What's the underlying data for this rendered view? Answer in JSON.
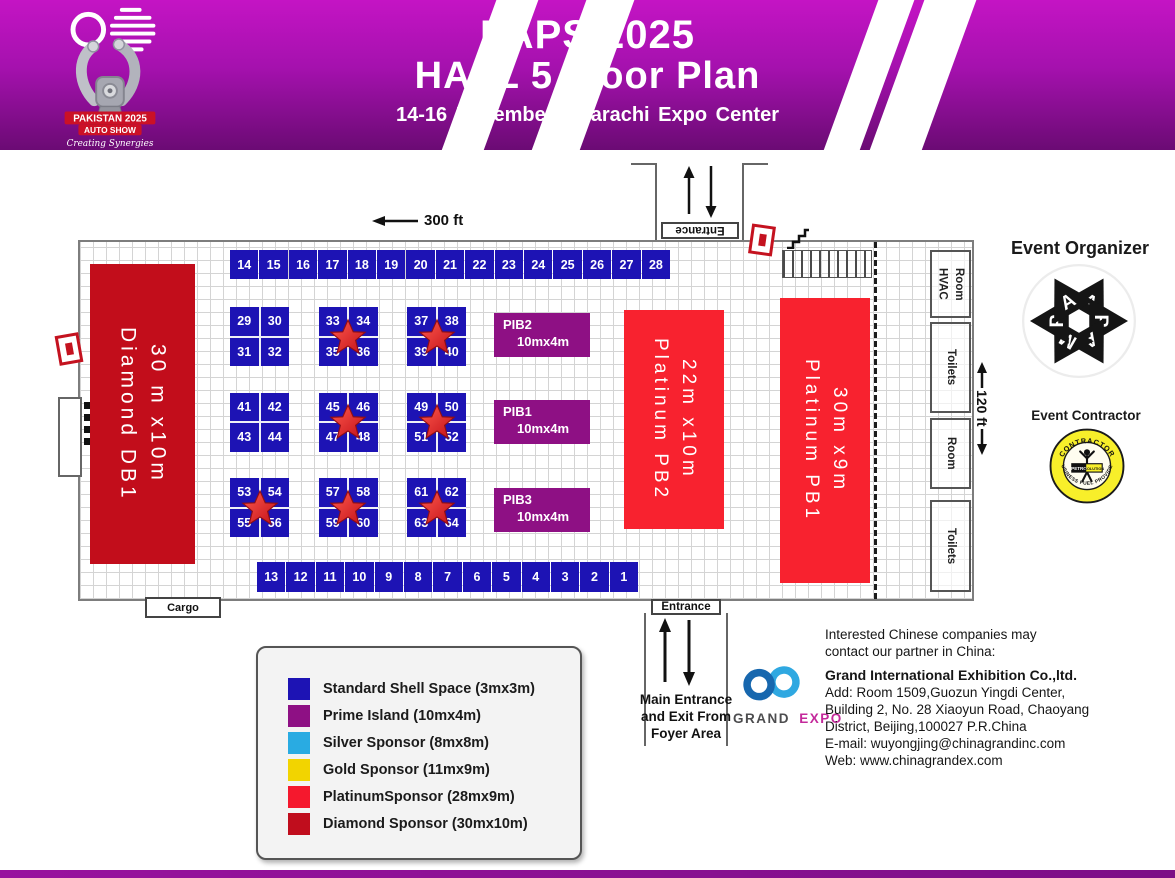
{
  "header": {
    "title_line1": "PAPS 2025",
    "title_line2": "HALL 5 Floor Plan",
    "subtitle": "14-16 November  |  Karachi Expo Center",
    "logo": {
      "name_line1": "PAKISTAN 2025",
      "name_line2": "AUTO SHOW",
      "tagline": "Creating Synergies"
    }
  },
  "floorplan": {
    "width_label": "300 ft",
    "height_label": "120 ft",
    "top_entrance_label": "Entrance",
    "bottom_entrance_label": "Entrance",
    "bottom_entrance_caption": "Main Entrance and Exit From Foyer Area",
    "cargo_label": "Cargo",
    "top_row_booths": [
      "14",
      "15",
      "16",
      "17",
      "18",
      "19",
      "20",
      "21",
      "22",
      "23",
      "24",
      "25",
      "26",
      "27",
      "28"
    ],
    "bottom_row_booths": [
      "13",
      "12",
      "11",
      "10",
      "9",
      "8",
      "7",
      "6",
      "5",
      "4",
      "3",
      "2",
      "1"
    ],
    "island_blocks": [
      {
        "booths": [
          "29",
          "30",
          "31",
          "32"
        ],
        "star": false
      },
      {
        "booths": [
          "33",
          "34",
          "35",
          "36"
        ],
        "star": true
      },
      {
        "booths": [
          "37",
          "38",
          "39",
          "40"
        ],
        "star": true
      },
      {
        "booths": [
          "41",
          "42",
          "43",
          "44"
        ],
        "star": false
      },
      {
        "booths": [
          "45",
          "46",
          "47",
          "48"
        ],
        "star": true
      },
      {
        "booths": [
          "49",
          "50",
          "51",
          "52"
        ],
        "star": true
      },
      {
        "booths": [
          "53",
          "54",
          "55",
          "56"
        ],
        "star": true
      },
      {
        "booths": [
          "57",
          "58",
          "59",
          "60"
        ],
        "star": true
      },
      {
        "booths": [
          "61",
          "62",
          "63",
          "64"
        ],
        "star": true
      }
    ],
    "prime_islands": [
      {
        "name": "PIB2",
        "size": "10mx4m"
      },
      {
        "name": "PIB1",
        "size": "10mx4m"
      },
      {
        "name": "PIB3",
        "size": "10mx4m"
      }
    ],
    "platinum_pb2": {
      "line1": "Platinum PB2",
      "line2": "22m x10m"
    },
    "platinum_pb1": {
      "line1": "Platinum PB1",
      "line2": "30m x9m"
    },
    "diamond_db1": {
      "line1": "Diamond DB1",
      "line2": "30 m x10m"
    },
    "rooms": [
      "HVAC\nRoom",
      "Toilets",
      "Room",
      "Toilets"
    ]
  },
  "legend": {
    "items": [
      {
        "label": "Standard Shell Space (3mx3m)",
        "color": "#1d13b4"
      },
      {
        "label": "Prime Island (10mx4m)",
        "color": "#8e1084"
      },
      {
        "label": "Silver Sponsor (8mx8m)",
        "color": "#29abe2"
      },
      {
        "label": "Gold Sponsor (11mx9m)",
        "color": "#f2d400"
      },
      {
        "label": "PlatinumSponsor (28mx9m)",
        "color": "#f5182d"
      },
      {
        "label": "Diamond  Sponsor (30mx10m)",
        "color": "#c00d1d"
      }
    ]
  },
  "organizer": {
    "heading": "Event Organizer",
    "letters": [
      "A",
      "P",
      "A",
      "M",
      "P",
      "A"
    ]
  },
  "contractor": {
    "heading": "Event Contractor",
    "arc_top": "CONTRACTOR",
    "arc_bottom": "BUSINESS FUEL PROVIDER",
    "box_left": "PETRO",
    "box_right": "SOLUTION"
  },
  "partner": {
    "intro_line1": "Interested Chinese companies may",
    "intro_line2": "contact our partner in China:",
    "company": "Grand International Exhibition Co.,ltd.",
    "address_line1": "Add: Room 1509,Guozun Yingdi Center,",
    "address_line2": "Building 2, No. 28 Xiaoyun Road, Chaoyang",
    "address_line3": "District, Beijing,100027 P.R.China",
    "email_line": " E-mail: wuyongjing@chinagrandinc.com",
    "web_line": "Web: www.chinagrandex.com",
    "logo_word1": "GRAND",
    "logo_word2": "EXPO"
  },
  "colors": {
    "booth_blue": "#1d13b4",
    "prime_purple": "#8e1084",
    "platinum_red": "#f8222f",
    "diamond_red": "#c20d1b",
    "header_purple_top": "#c414c4",
    "header_purple_bottom": "#6b0b74"
  }
}
